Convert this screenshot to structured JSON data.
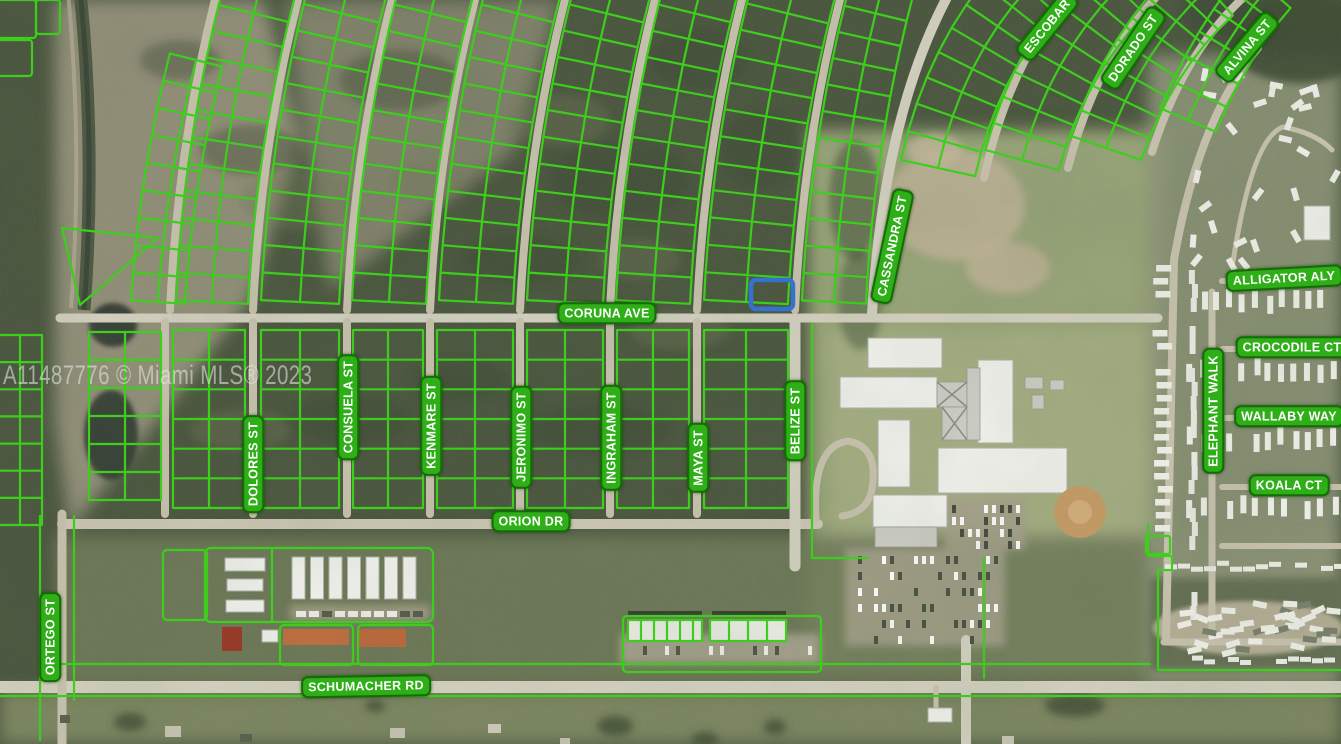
{
  "map": {
    "type": "aerial-parcel-map",
    "watermark": {
      "text": "A11487776 © Miami MLS® 2023",
      "color": "rgba(230,232,228,0.58)"
    },
    "highlighted_parcel": {
      "x": 751,
      "y": 280,
      "width": 42,
      "height": 29,
      "color": "#2B6FDA"
    },
    "colors": {
      "parcel_outline": "#35D512",
      "label_bg": "#2EAE17",
      "label_border": "#156B06",
      "label_text": "#FFFFFF",
      "road": "#C9C3AF",
      "road_major": "#D5D1C1"
    },
    "labels": [
      {
        "id": "ortego-st",
        "text": "ORTEGO ST",
        "x": 50,
        "y": 637,
        "rotate": -90
      },
      {
        "id": "dolores-st",
        "text": "DOLORES ST",
        "x": 253,
        "y": 464,
        "rotate": -90
      },
      {
        "id": "consuela-st",
        "text": "CONSUELA ST",
        "x": 348,
        "y": 407,
        "rotate": -90
      },
      {
        "id": "kenmare-st",
        "text": "KENMARE ST",
        "x": 431,
        "y": 426,
        "rotate": -90
      },
      {
        "id": "jeronimo-st",
        "text": "JERONIMO ST",
        "x": 521,
        "y": 437,
        "rotate": -90
      },
      {
        "id": "ingraham-st",
        "text": "INGRAHAM ST",
        "x": 611,
        "y": 438,
        "rotate": -90
      },
      {
        "id": "maya-st",
        "text": "MAYA ST",
        "x": 698,
        "y": 458,
        "rotate": -90
      },
      {
        "id": "belize-st",
        "text": "BELIZE ST",
        "x": 795,
        "y": 421,
        "rotate": -90
      },
      {
        "id": "cassandra-st",
        "text": "CASSANDRA ST",
        "x": 892,
        "y": 246,
        "rotate": -78
      },
      {
        "id": "coruna-ave",
        "text": "CORUNA AVE",
        "x": 607,
        "y": 313,
        "rotate": 0
      },
      {
        "id": "orion-dr",
        "text": "ORION DR",
        "x": 531,
        "y": 521,
        "rotate": 0
      },
      {
        "id": "schumacher-rd",
        "text": "SCHUMACHER RD",
        "x": 366,
        "y": 686,
        "rotate": -1
      },
      {
        "id": "escobar",
        "text": "ESCOBAR",
        "x": 1047,
        "y": 26,
        "rotate": -51
      },
      {
        "id": "dorado-st",
        "text": "DORADO ST",
        "x": 1133,
        "y": 48,
        "rotate": -56
      },
      {
        "id": "alvina-st",
        "text": "ALVINA ST",
        "x": 1247,
        "y": 47,
        "rotate": -50
      },
      {
        "id": "alligator-aly",
        "text": "ALLIGATOR ALY",
        "x": 1284,
        "y": 278,
        "rotate": -3
      },
      {
        "id": "crocodile-ct",
        "text": "CROCODILE CT",
        "x": 1292,
        "y": 347,
        "rotate": 0
      },
      {
        "id": "wallaby-way",
        "text": "WALLABY WAY",
        "x": 1289,
        "y": 416,
        "rotate": 0
      },
      {
        "id": "elephant-walk",
        "text": "ELEPHANT WALK",
        "x": 1213,
        "y": 411,
        "rotate": -90
      },
      {
        "id": "koala-ct",
        "text": "KOALA CT",
        "x": 1289,
        "y": 485,
        "rotate": 0
      }
    ]
  }
}
